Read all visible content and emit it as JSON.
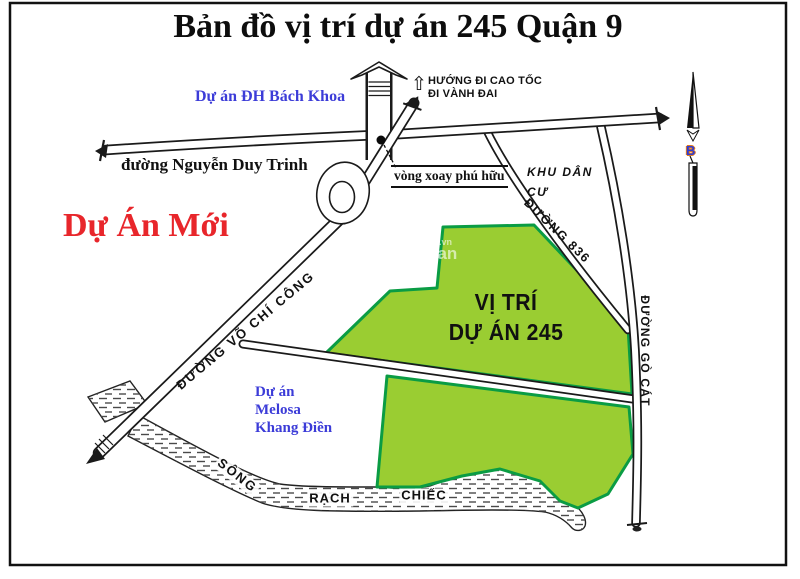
{
  "title": "Bản đồ vị trí dự án 245 Quận 9",
  "labels": {
    "bach_khoa_project": "Dự án ĐH Bách Khoa",
    "highway_direction": "HƯỚNG ĐI CAO TỐC\nĐI VÀNH ĐAI",
    "nguyen_duy_trinh_road": "đường Nguyễn Duy Trinh",
    "phu_huu_roundabout": "vòng xoay phú hữu",
    "residential_area": "KHU DÂN\nCƯ",
    "road_836": "ĐƯỜNG 836",
    "new_project": "Dự Án Mới",
    "project_245_location": "VỊ TRÍ\nDỰ ÁN 245",
    "vo_chi_cong_road": "ĐƯỜNG VÕ CHÍ CÔNG",
    "go_cat_road": "ĐƯỜNG GÒ CÁT",
    "melosa_project": "Dự án\nMelosa\nKhang Điền",
    "river_song": "SÔNG",
    "river_rach": "RẠCH",
    "river_chiec": "CHIẾC",
    "compass_north": "B",
    "watermark_top": "m.vn",
    "watermark_bottom": "san"
  },
  "icons": {
    "direction_up_arrow": "⇧"
  },
  "colors": {
    "project_fill": "#9ACD32",
    "project_border": "#0A9C44",
    "new_project_text": "#E8262B",
    "blue_label": "#3C3CD8",
    "road_line": "#1a1a1a",
    "compass_b_fill": "#2B3BD7",
    "compass_b_outline": "#E0791E"
  }
}
